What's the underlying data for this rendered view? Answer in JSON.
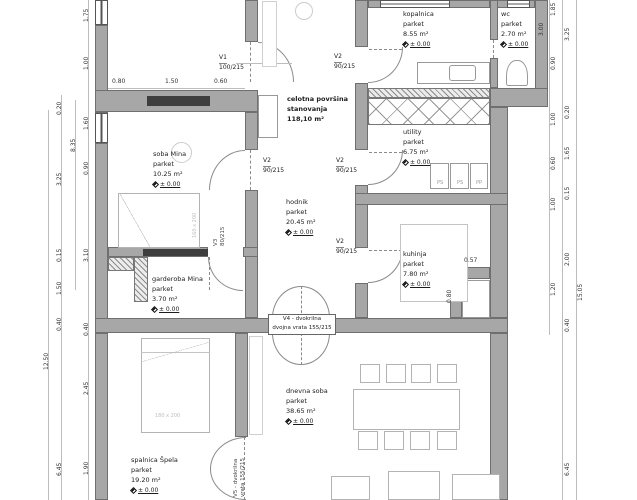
{
  "summary": {
    "line1": "celotna površina",
    "line2": "stanovanja",
    "area": "118,10 m²"
  },
  "rooms": {
    "kopalnica": {
      "name": "kopalnica",
      "finish": "parket",
      "area": "8.55 m²",
      "elev": "± 0.00"
    },
    "wc": {
      "name": "wc",
      "finish": "parket",
      "area": "2.70 m²",
      "elev": "± 0.00"
    },
    "utility": {
      "name": "utility",
      "finish": "parket",
      "area": "6.75 m²",
      "elev": "± 0.00"
    },
    "kuhinja": {
      "name": "kuhinja",
      "finish": "parket",
      "area": "7.80 m²",
      "elev": "± 0.00"
    },
    "hodnik": {
      "name": "hodnik",
      "finish": "parket",
      "area": "20.45 m²",
      "elev": "± 0.00"
    },
    "soba_mina": {
      "name": "soba Mina",
      "finish": "parket",
      "area": "10.25 m²",
      "elev": "± 0.00"
    },
    "garderoba": {
      "name": "garderoba Mina",
      "finish": "parket",
      "area": "3.70 m²",
      "elev": "± 0.00"
    },
    "spalnica": {
      "name": "spalnica Špela",
      "finish": "parket",
      "area": "19.20 m²",
      "elev": "± 0.00"
    },
    "dnevna": {
      "name": "dnevna soba",
      "finish": "parket",
      "area": "38.65 m²",
      "elev": "± 0.00"
    }
  },
  "doors": {
    "v1": {
      "name": "V1",
      "size": "100/215"
    },
    "v2": {
      "name": "V2",
      "size": "90/215"
    },
    "v3": {
      "name": "V3",
      "size": "80/215"
    },
    "v4": {
      "line1": "V4 - dvokrilna",
      "line2": "dvojna vrata 155/215"
    },
    "v5": {
      "line1": "V5 - dvokrilna",
      "line2": "vrata 155/215"
    }
  },
  "furniture": {
    "bed_spalnica": "180 x 200",
    "bed_mina": "160 x 200",
    "appliance1": "PS",
    "appliance2": "PS",
    "appliance3": "PP"
  },
  "dims": {
    "left_inner": [
      "1.75",
      "1.00",
      "1.60",
      "0.90",
      "3.10",
      "0.40",
      "2.45",
      "1.90"
    ],
    "left_mid": [
      "0.20",
      "3.25",
      "0.15",
      "1.50",
      "0.40",
      "6.45"
    ],
    "left_seg": "8.35",
    "left_total": "12.50",
    "right_inner": [
      "1.85",
      "0.90",
      "1.00",
      "0.60",
      "1.00",
      "1.20"
    ],
    "right_mid": [
      "3.25",
      "0.20",
      "1.65",
      "0.15",
      "2.00",
      "0.40",
      "6.45"
    ],
    "right_total": "15.05",
    "wc_wall": "3.00",
    "top_room": [
      "0.80",
      "1.50",
      "0.60"
    ],
    "kitchen_w": "0.57",
    "kitchen_h": "0.80"
  }
}
